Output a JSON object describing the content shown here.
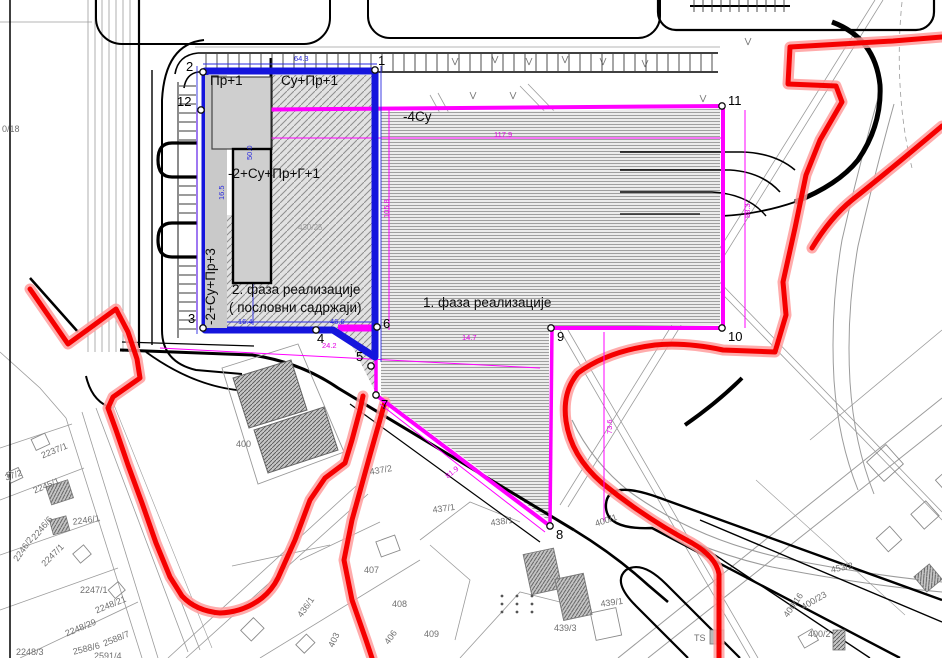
{
  "map": {
    "type": "urban-planning-cadastral-map",
    "phase1_area_label": "1. фаза реализације",
    "phase2_area_label": "2. фаза реализације ( пословни садржаји)",
    "colors": {
      "boundary_red": "#ff0000",
      "phase1_magenta": "#ff00ff",
      "phase2_blue": "#1515dd",
      "road_black": "#000000",
      "parcel_gray": "#9b9b9b",
      "building_fill": "#cfcfcf",
      "hatch_gray": "#8d8d8d"
    }
  },
  "labels": [
    {
      "t": "Пр+1",
      "x": 210,
      "y": 74,
      "c": "bl"
    },
    {
      "t": "Су+Пр+1",
      "x": 281,
      "y": 74,
      "c": "bl"
    },
    {
      "t": "-2+Су+Пр+Г+1",
      "x": 228,
      "y": 167,
      "c": "bl"
    },
    {
      "t": "-2+Су+Пр+3",
      "x": 204,
      "y": 325,
      "c": "bl",
      "r": -90
    },
    {
      "t": "2. фаза реализације",
      "x": 232,
      "y": 283,
      "c": "bl"
    },
    {
      "t": "( пословни садржаји)",
      "x": 229,
      "y": 301,
      "c": "bl"
    },
    {
      "t": "-4Су",
      "x": 403,
      "y": 110,
      "c": "bl"
    },
    {
      "t": "1. фаза реализације",
      "x": 423,
      "y": 296,
      "c": "bl"
    },
    {
      "t": "400",
      "x": 236,
      "y": 440,
      "c": "gr"
    },
    {
      "t": "430/25",
      "x": 298,
      "y": 224,
      "c": "gs"
    },
    {
      "t": "0/18",
      "x": 2,
      "y": 125,
      "c": "gr"
    },
    {
      "t": "2237/1",
      "x": 40,
      "y": 452,
      "c": "gr",
      "r": -22
    },
    {
      "t": "37/2",
      "x": 4,
      "y": 474,
      "c": "gr",
      "r": -18
    },
    {
      "t": "2245/1",
      "x": 32,
      "y": 487,
      "c": "gr",
      "r": -22
    },
    {
      "t": "2246/1",
      "x": 72,
      "y": 518,
      "c": "gr",
      "r": -8
    },
    {
      "t": "2246/6",
      "x": 30,
      "y": 536,
      "c": "gr",
      "r": -50
    },
    {
      "t": "2246/2",
      "x": 12,
      "y": 558,
      "c": "gr",
      "r": -55
    },
    {
      "t": "2247/1",
      "x": 40,
      "y": 562,
      "c": "gr",
      "r": -45
    },
    {
      "t": "2247/1",
      "x": 80,
      "y": 586,
      "c": "gr"
    },
    {
      "t": "2248/21",
      "x": 94,
      "y": 607,
      "c": "gr",
      "r": -22
    },
    {
      "t": "2248/29",
      "x": 64,
      "y": 630,
      "c": "gr",
      "r": -22
    },
    {
      "t": "2588/6",
      "x": 72,
      "y": 648,
      "c": "gr",
      "r": -14
    },
    {
      "t": "2588/7",
      "x": 102,
      "y": 640,
      "c": "gr",
      "r": -22
    },
    {
      "t": "2248/3",
      "x": 16,
      "y": 648,
      "c": "gr"
    },
    {
      "t": "2591/4",
      "x": 94,
      "y": 652,
      "c": "gr"
    },
    {
      "t": "437/2",
      "x": 369,
      "y": 468,
      "c": "gr",
      "r": -10
    },
    {
      "t": "437/1",
      "x": 432,
      "y": 506,
      "c": "gr",
      "r": -8
    },
    {
      "t": "438/1",
      "x": 490,
      "y": 519,
      "c": "gr",
      "r": -8
    },
    {
      "t": "400/1",
      "x": 594,
      "y": 520,
      "c": "gr",
      "r": -18
    },
    {
      "t": "407",
      "x": 364,
      "y": 566,
      "c": "gr"
    },
    {
      "t": "408",
      "x": 392,
      "y": 600,
      "c": "gr"
    },
    {
      "t": "409",
      "x": 424,
      "y": 630,
      "c": "gr"
    },
    {
      "t": "439/1",
      "x": 600,
      "y": 600,
      "c": "gr",
      "r": -8
    },
    {
      "t": "439/3",
      "x": 554,
      "y": 624,
      "c": "gr"
    },
    {
      "t": "436/1",
      "x": 296,
      "y": 614,
      "c": "gr",
      "r": -55
    },
    {
      "t": "403",
      "x": 327,
      "y": 645,
      "c": "gr",
      "r": -65
    },
    {
      "t": "406",
      "x": 383,
      "y": 641,
      "c": "gr",
      "r": -55
    },
    {
      "t": "453/2",
      "x": 830,
      "y": 566,
      "c": "gr",
      "r": -12
    },
    {
      "t": "400/23",
      "x": 800,
      "y": 604,
      "c": "gr",
      "r": -30
    },
    {
      "t": "400/2",
      "x": 808,
      "y": 630,
      "c": "gr"
    },
    {
      "t": "400/16",
      "x": 782,
      "y": 614,
      "c": "gr",
      "r": -55
    },
    {
      "t": "TS",
      "x": 694,
      "y": 634,
      "c": "gr"
    },
    {
      "t": "64.3",
      "x": 294,
      "y": 55,
      "c": "bu"
    },
    {
      "t": "16.4",
      "x": 238,
      "y": 318,
      "c": "bu"
    },
    {
      "t": "46.6",
      "x": 330,
      "y": 318,
      "c": "bu"
    },
    {
      "t": "16.5",
      "x": 218,
      "y": 200,
      "c": "bu",
      "r": -90
    },
    {
      "t": "50.0",
      "x": 246,
      "y": 160,
      "c": "bu",
      "r": -90
    },
    {
      "t": "105.8",
      "x": 383,
      "y": 218,
      "c": "mg",
      "r": -90
    },
    {
      "t": "117.9",
      "x": 494,
      "y": 131,
      "c": "mg"
    },
    {
      "t": "88.3",
      "x": 744,
      "y": 218,
      "c": "mg",
      "r": -90
    },
    {
      "t": "73.6",
      "x": 606,
      "y": 434,
      "c": "mg",
      "r": -90
    },
    {
      "t": "81.9",
      "x": 444,
      "y": 474,
      "c": "mg",
      "r": -38
    },
    {
      "t": "24.2",
      "x": 322,
      "y": 342,
      "c": "mg"
    },
    {
      "t": "14.7",
      "x": 462,
      "y": 334,
      "c": "mg"
    }
  ],
  "points": [
    {
      "n": "1",
      "mx": 375,
      "my": 70,
      "lx": 378,
      "ly": 54
    },
    {
      "n": "2",
      "mx": 203,
      "my": 72,
      "lx": 186,
      "ly": 60
    },
    {
      "n": "3",
      "mx": 203,
      "my": 328,
      "lx": 188,
      "ly": 312
    },
    {
      "n": "4",
      "mx": 316,
      "my": 330,
      "lx": 317,
      "ly": 332
    },
    {
      "n": "5",
      "mx": 371,
      "my": 366,
      "lx": 356,
      "ly": 350
    },
    {
      "n": "6",
      "mx": 377,
      "my": 327,
      "lx": 383,
      "ly": 317
    },
    {
      "n": "7",
      "mx": 376,
      "my": 395,
      "lx": 381,
      "ly": 398
    },
    {
      "n": "8",
      "mx": 550,
      "my": 526,
      "lx": 556,
      "ly": 528
    },
    {
      "n": "9",
      "mx": 551,
      "my": 328,
      "lx": 557,
      "ly": 330
    },
    {
      "n": "10",
      "mx": 722,
      "my": 328,
      "lx": 728,
      "ly": 330
    },
    {
      "n": "11",
      "mx": 722,
      "my": 106,
      "lx": 728,
      "ly": 94
    },
    {
      "n": "12",
      "mx": 201,
      "my": 110,
      "lx": 177,
      "ly": 95
    }
  ]
}
